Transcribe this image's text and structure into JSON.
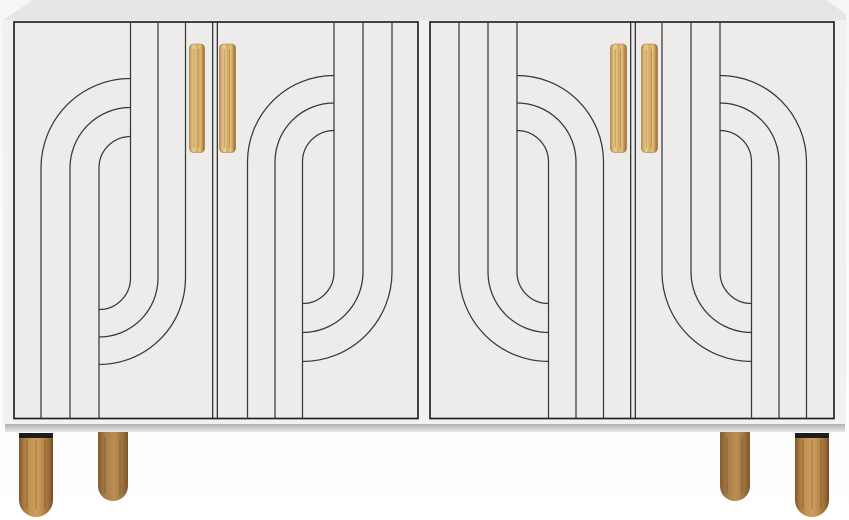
{
  "product": {
    "description": "White four-door sideboard with art-deco curved groove pattern, natural wood vertical bar handles and round tapered wood legs"
  },
  "scene": {
    "width": 849,
    "height": 520
  },
  "palette": {
    "gradients": [
      {
        "id": "shadowGrad",
        "dir": "v",
        "stops": [
          [
            0,
            "#aeaeae"
          ],
          [
            0.4,
            "#c7c7c7"
          ],
          [
            1,
            "#e9e9e9"
          ]
        ]
      },
      {
        "id": "woodHandle",
        "dir": "h",
        "stops": [
          [
            0,
            "#b3863f"
          ],
          [
            0.12,
            "#d9b172"
          ],
          [
            0.32,
            "#ecce90"
          ],
          [
            0.5,
            "#d4a961"
          ],
          [
            0.7,
            "#e5c37f"
          ],
          [
            0.87,
            "#bd8f4b"
          ],
          [
            1,
            "#97692c"
          ]
        ]
      },
      {
        "id": "woodLegFront",
        "dir": "h",
        "stops": [
          [
            0,
            "#7d5328"
          ],
          [
            0.12,
            "#a5763f"
          ],
          [
            0.32,
            "#c79354"
          ],
          [
            0.52,
            "#d09d5d"
          ],
          [
            0.72,
            "#b8864a"
          ],
          [
            0.9,
            "#966937"
          ],
          [
            1,
            "#744d25"
          ]
        ]
      },
      {
        "id": "woodLegBack",
        "dir": "h",
        "stops": [
          [
            0,
            "#835c31"
          ],
          [
            0.25,
            "#a87e4a"
          ],
          [
            0.55,
            "#bc8e52"
          ],
          [
            0.8,
            "#9d7341"
          ],
          [
            1,
            "#7b572e"
          ]
        ]
      }
    ]
  },
  "cabinet": {
    "body_path": "M3,20 L33,0 L826,0 L846,14 L846,424 L3,424 Z",
    "top_path": "M3,20 L33,0 L826,0 L846,14 L846,20.5 L3,20.5 Z",
    "face_color": "#f2f1ef",
    "top_color": "#e7e6e4",
    "base_shadow": {
      "x": 5,
      "y": 424,
      "w": 840,
      "h": 8,
      "gradient": "shadowGrad"
    }
  },
  "doors": {
    "frame_color": "#242424",
    "panel_color": "#edecea",
    "groove_color": "#383838",
    "pairs": [
      {
        "name": "door-pair-left",
        "x": 14,
        "y": 22,
        "w": 404,
        "h": 396.5,
        "gap_x": 215
      },
      {
        "name": "door-pair-right",
        "x": 430,
        "y": 22,
        "w": 404,
        "h": 396.5,
        "gap_x": 633
      }
    ],
    "grooves": [
      {
        "door": "door-1",
        "paths": [
          "M130.5 22 V278 A31.5 31.5 0 0 1 99 309.5",
          "M158 22 V278 A59 59 0 0 1 99 337",
          "M185.5 22 V278 A86.5 86.5 0 0 1 99 364.5",
          "M41 418.5 V168 A89.5 89.5 0 0 1 130.5 78.5",
          "M70 418.5 V168 A60.5 60.5 0 0 1 130.5 107.5",
          "M99 418.5 V168 A31.5 31.5 0 0 1 130.5 136.5"
        ]
      },
      {
        "door": "door-2",
        "paths": [
          "M302.5 418.5 V162 A31.5 31.5 0 0 1 334 130.5",
          "M275 418.5 V162 A59 59 0 0 1 334 103",
          "M247.5 418.5 V162 A86.5 86.5 0 0 1 334 75.5",
          "M392 22 V272 A89.5 89.5 0 0 1 302.5 361.5",
          "M363 22 V272 A60.5 60.5 0 0 1 302.5 332.5",
          "M334 22 V272 A31.5 31.5 0 0 1 302.5 303.5"
        ]
      },
      {
        "door": "door-3",
        "paths": [
          "M548.5 418.5 V162 A31.5 31.5 0 0 0 517 130.5",
          "M576 418.5 V162 A59 59 0 0 0 517 103",
          "M603.5 418.5 V162 A86.5 86.5 0 0 0 517 75.5",
          "M459 22 V272 A89.5 89.5 0 0 0 548.5 361.5",
          "M488 22 V272 A60.5 60.5 0 0 0 548.5 332.5",
          "M517 22 V272 A31.5 31.5 0 0 0 548.5 303.5"
        ]
      },
      {
        "door": "door-4",
        "paths": [
          "M751.5 418.5 V162 A31.5 31.5 0 0 0 720 130.5",
          "M779 418.5 V162 A59 59 0 0 0 720 103",
          "M806.5 418.5 V162 A86.5 86.5 0 0 0 720 75.5",
          "M662 22 V272 A89.5 89.5 0 0 0 751.5 361.5",
          "M691 22 V272 A60.5 60.5 0 0 0 751.5 332.5",
          "M720 22 V272 A31.5 31.5 0 0 0 751.5 303.5"
        ]
      }
    ]
  },
  "handles": {
    "gradient": "woodHandle",
    "stroke": "rgba(122,86,36,0.5)",
    "grain_color": "rgba(140,100,44,0.45)",
    "items": [
      {
        "name": "handle-door-1",
        "x": 189.5,
        "y": 44,
        "w": 15,
        "h": 108.5
      },
      {
        "name": "handle-door-2",
        "x": 219.5,
        "y": 44,
        "w": 16,
        "h": 108.5
      },
      {
        "name": "handle-door-3",
        "x": 610.5,
        "y": 44,
        "w": 16,
        "h": 108.5
      },
      {
        "name": "handle-door-4",
        "x": 641.5,
        "y": 44,
        "w": 16,
        "h": 108.5
      }
    ]
  },
  "legs": {
    "front_gradient": "woodLegFront",
    "back_gradient": "woodLegBack",
    "cap_color": "#1d1d1d",
    "grain_color": "rgba(88,56,20,0.28)",
    "items": [
      {
        "name": "leg-front-left",
        "front": true,
        "path": "M19,433 L53,433 L53,500 A17,17 0 0 1 36,517 A17,17 0 0 1 19,500 Z",
        "cap": {
          "x": 19,
          "y": 433,
          "w": 34,
          "h": 5
        },
        "grain_x": [
          27,
          36,
          45
        ],
        "grain_y": [
          440,
          509
        ]
      },
      {
        "name": "leg-back-left",
        "front": false,
        "path": "M98,432 L128,432 L128,486 A15,15 0 0 1 113,501 A15,15 0 0 1 98,486 Z",
        "cap": null,
        "grain_x": [
          105,
          120
        ],
        "grain_y": [
          438,
          494
        ]
      },
      {
        "name": "leg-back-right",
        "front": false,
        "path": "M720,432 L750,432 L750,486 A15,15 0 0 1 735,501 A15,15 0 0 1 720,486 Z",
        "cap": null,
        "grain_x": [
          727,
          742
        ],
        "grain_y": [
          438,
          494
        ]
      },
      {
        "name": "leg-front-right",
        "front": true,
        "path": "M795,433 L829,433 L829,500 A17,17 0 0 1 812,517 A17,17 0 0 1 795,500 Z",
        "cap": {
          "x": 795,
          "y": 433,
          "w": 34,
          "h": 5
        },
        "grain_x": [
          803,
          812,
          821
        ],
        "grain_y": [
          440,
          509
        ]
      }
    ]
  }
}
